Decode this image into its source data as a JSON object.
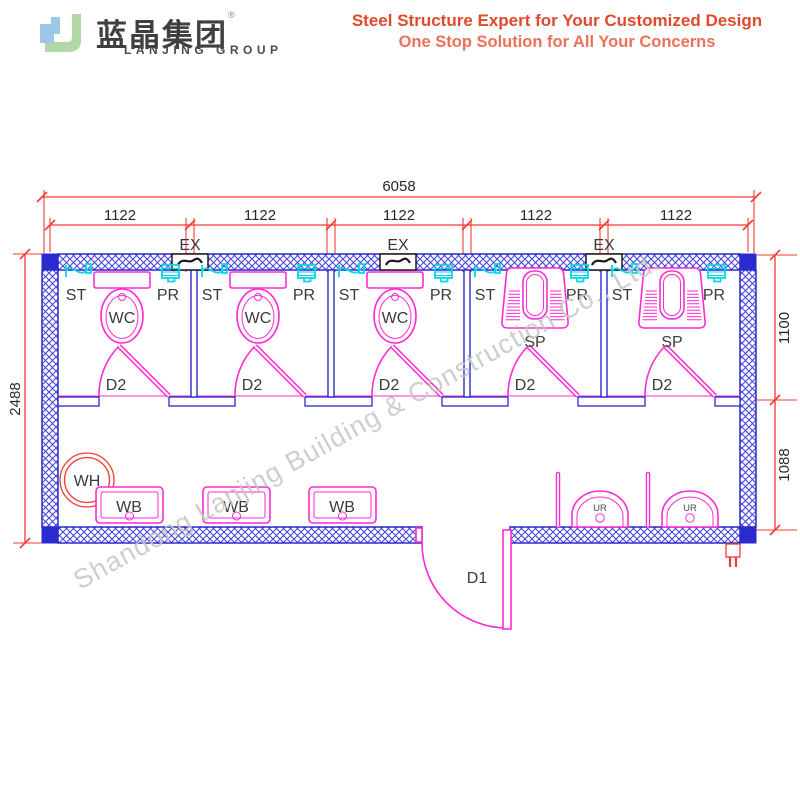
{
  "header": {
    "brand_cn": "蓝晶集团",
    "brand_reg": "®",
    "brand_en": "LANJING GROUP",
    "tagline_line1": "Steel Structure Expert for Your Customized Design",
    "tagline_line2": "One Stop Solution for All Your Concerns",
    "colors": {
      "tagline1": "#e2492a",
      "tagline2": "#ee7058",
      "logo_blue": "#9dc6e8",
      "logo_green": "#b2d8a6"
    }
  },
  "drawing": {
    "dims": {
      "overall_width": "6058",
      "module_width": "1122",
      "overall_height": "2488",
      "upper_depth": "1100",
      "lower_depth": "1088"
    },
    "labels": {
      "ex": "EX",
      "st": "ST",
      "pr": "PR",
      "wc": "WC",
      "sp": "SP",
      "d2": "D2",
      "d1": "D1",
      "wh": "WH",
      "wb": "WB",
      "ur": "UR"
    },
    "watermark": "Shandong Lanjing Building & Construction Co., Ltd.",
    "colors": {
      "wall_blue": "#2a2ace",
      "fixture_magenta": "#ff2ad4",
      "plumbing_cyan": "#00d9e9",
      "dimension_red": "#f23b30",
      "label_gray": "#3a3a3a",
      "exhaust_black": "#1a1a1a",
      "watermark_gray": "#c6c6c6"
    }
  }
}
